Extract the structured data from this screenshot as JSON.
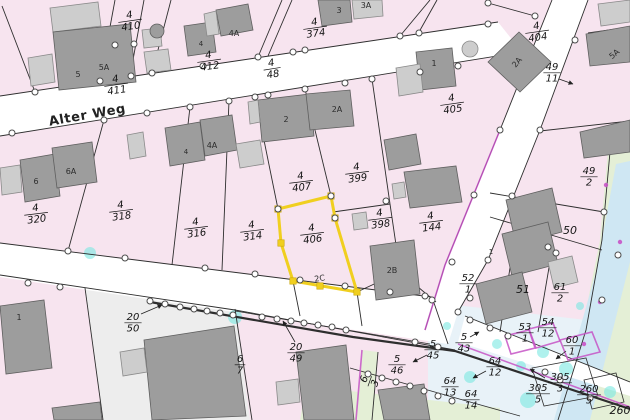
{
  "map": {
    "street_label": {
      "text": "Alter Weg",
      "x": 88,
      "y": 119,
      "rot": -10
    },
    "highlighted_parcel": {
      "num": "4",
      "den": "406"
    },
    "colors": {
      "parcel_pink": "#f7e4ef",
      "street_white": "#ffffff",
      "area_gray": "#ededed",
      "area_green": "#e4efd6",
      "water_blue": "#cfe7f3",
      "wetland_blue": "#e8f2f8",
      "building_dark": "#9d9d9d",
      "building_light": "#cdcdcd",
      "highlight_yellow": "#f0cf1f",
      "marker_cyan": "#79e8e1",
      "boundary_violet": "#c653c6",
      "line_black": "#2e2e2e"
    },
    "parcel_labels": [
      {
        "num": "4",
        "den": "410",
        "x": 130,
        "y": 20,
        "rot": -8
      },
      {
        "num": "4",
        "den": "412",
        "x": 209,
        "y": 60,
        "rot": -8
      },
      {
        "num": "4",
        "den": "411",
        "x": 116,
        "y": 84,
        "rot": -8
      },
      {
        "num": "4",
        "den": "374",
        "x": 315,
        "y": 27,
        "rot": -8
      },
      {
        "num": "4",
        "den": "404",
        "x": 537,
        "y": 31,
        "rot": -8
      },
      {
        "num": "4",
        "den": "405",
        "x": 452,
        "y": 103,
        "rot": -8
      },
      {
        "num": "4",
        "den": "48",
        "x": 272,
        "y": 68,
        "rot": -9
      },
      {
        "num": "49",
        "den": "11",
        "x": 552,
        "y": 72,
        "rot": 0
      },
      {
        "num": "4",
        "den": "320",
        "x": 36,
        "y": 213,
        "rot": -7
      },
      {
        "num": "4",
        "den": "318",
        "x": 121,
        "y": 210,
        "rot": -7
      },
      {
        "num": "4",
        "den": "316",
        "x": 196,
        "y": 227,
        "rot": -7
      },
      {
        "num": "4",
        "den": "314",
        "x": 252,
        "y": 230,
        "rot": -7
      },
      {
        "num": "4",
        "den": "407",
        "x": 301,
        "y": 181,
        "rot": -7
      },
      {
        "num": "4",
        "den": "399",
        "x": 357,
        "y": 172,
        "rot": -7
      },
      {
        "num": "4",
        "den": "406",
        "x": 312,
        "y": 233,
        "rot": -7
      },
      {
        "num": "4",
        "den": "398",
        "x": 380,
        "y": 218,
        "rot": -7
      },
      {
        "num": "4",
        "den": "144",
        "x": 431,
        "y": 221,
        "rot": -7
      },
      {
        "num": "49",
        "den": "2",
        "x": 589,
        "y": 176,
        "rot": 0
      },
      {
        "num": "50",
        "den": null,
        "x": 570,
        "y": 231,
        "rot": 0
      },
      {
        "num": "20",
        "den": "50",
        "x": 133,
        "y": 322,
        "rot": 0
      },
      {
        "num": "6",
        "den": "7",
        "x": 240,
        "y": 364,
        "rot": 0
      },
      {
        "num": "20",
        "den": "49",
        "x": 296,
        "y": 352,
        "rot": 0
      },
      {
        "num": "5",
        "den": "46",
        "x": 397,
        "y": 364,
        "rot": 0
      },
      {
        "num": "5",
        "den": "45",
        "x": 433,
        "y": 349,
        "rot": 0
      },
      {
        "num": "6",
        "den": "3",
        "x": 369,
        "y": 381,
        "rot": -70
      },
      {
        "num": "5",
        "den": "43",
        "x": 464,
        "y": 342,
        "rot": 0
      },
      {
        "num": "64",
        "den": "12",
        "x": 495,
        "y": 366,
        "rot": 0
      },
      {
        "num": "64",
        "den": "13",
        "x": 450,
        "y": 386,
        "rot": 0
      },
      {
        "num": "64",
        "den": "14",
        "x": 471,
        "y": 399,
        "rot": 0
      },
      {
        "num": "52",
        "den": "1",
        "x": 468,
        "y": 283,
        "rot": 0
      },
      {
        "num": "51",
        "den": null,
        "x": 523,
        "y": 290,
        "rot": 0
      },
      {
        "num": "61",
        "den": "2",
        "x": 560,
        "y": 292,
        "rot": 0
      },
      {
        "num": "53",
        "den": "1",
        "x": 525,
        "y": 332,
        "rot": 0
      },
      {
        "num": "54",
        "den": "12",
        "x": 548,
        "y": 327,
        "rot": 0
      },
      {
        "num": "60",
        "den": "1",
        "x": 572,
        "y": 345,
        "rot": 0
      },
      {
        "num": "305",
        "den": "3",
        "x": 560,
        "y": 382,
        "rot": 0
      },
      {
        "num": "305",
        "den": "5",
        "x": 538,
        "y": 393,
        "rot": 0
      },
      {
        "num": "260",
        "den": "5",
        "x": 589,
        "y": 394,
        "rot": 0
      },
      {
        "num": "260",
        "den": null,
        "x": 620,
        "y": 411,
        "rot": 0
      }
    ],
    "building_labels": [
      {
        "text": "5",
        "x": 78,
        "y": 77
      },
      {
        "text": "5A",
        "x": 104,
        "y": 70
      },
      {
        "text": "4",
        "x": 201,
        "y": 46,
        "size": 7
      },
      {
        "text": "4A",
        "x": 234,
        "y": 36
      },
      {
        "text": "3",
        "x": 339,
        "y": 13
      },
      {
        "text": "3A",
        "x": 366,
        "y": 8
      },
      {
        "text": "2",
        "x": 286,
        "y": 122
      },
      {
        "text": "2A",
        "x": 337,
        "y": 112
      },
      {
        "text": "1",
        "x": 434,
        "y": 66
      },
      {
        "text": "2A",
        "x": 519,
        "y": 64,
        "rot": -50
      },
      {
        "text": "4",
        "x": 186,
        "y": 154,
        "size": 7
      },
      {
        "text": "4A",
        "x": 212,
        "y": 148
      },
      {
        "text": "6",
        "x": 36,
        "y": 184
      },
      {
        "text": "6A",
        "x": 71,
        "y": 174
      },
      {
        "text": "1",
        "x": 19,
        "y": 320
      },
      {
        "text": "2B",
        "x": 392,
        "y": 273
      },
      {
        "text": "5A",
        "x": 616,
        "y": 56,
        "rot": -40
      },
      {
        "text": "2C",
        "x": 320,
        "y": 281,
        "rot": -8
      },
      {
        "text": "1",
        "x": 491,
        "y": 254,
        "size": 7
      }
    ]
  }
}
